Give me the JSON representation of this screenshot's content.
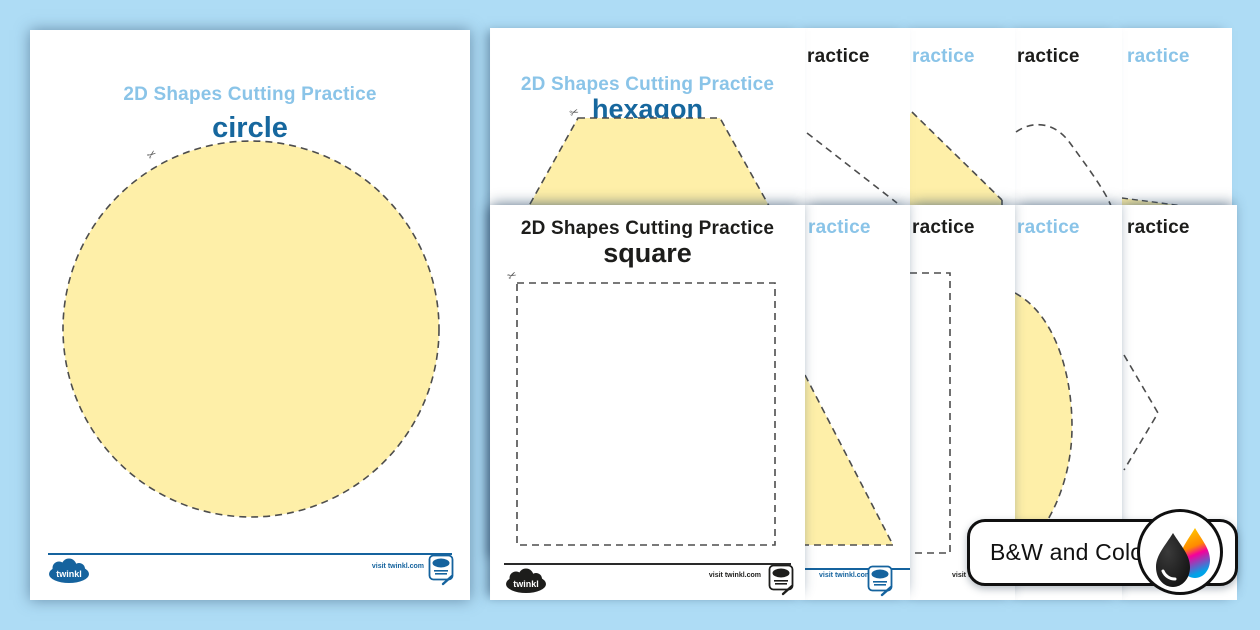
{
  "title": "2D Shapes Cutting Practice",
  "worksheets": {
    "circle": {
      "header": "2D Shapes Cutting Practice",
      "label": "circle",
      "variant": "color"
    },
    "hexagon": {
      "header": "2D Shapes Cutting Practice",
      "label": "hexagon",
      "variant": "color"
    },
    "square": {
      "header": "2D Shapes Cutting Practice",
      "label": "square",
      "variant": "black-and-white"
    },
    "partials": [
      {
        "header_fragment": "ractice",
        "variant": "black-and-white"
      },
      {
        "header_fragment": "ractice",
        "variant": "color"
      },
      {
        "header_fragment": "ractice",
        "variant": "black-and-white"
      },
      {
        "header_fragment": "ractice",
        "variant": "color"
      },
      {
        "header_fragment": "ractice",
        "variant": "color"
      },
      {
        "header_fragment": "ractice",
        "variant": "black-and-white"
      },
      {
        "header_fragment": "ractice",
        "variant": "color"
      },
      {
        "header_fragment": "ractice",
        "variant": "black-and-white"
      }
    ]
  },
  "footer": {
    "brand": "twinkl",
    "visit_text": "visit twinkl.com"
  },
  "badge": {
    "label": "B&W and Color",
    "icon": "ink-drops-icon"
  },
  "colors": {
    "background": "#aedcf5",
    "header_blue": "#8ac4e8",
    "shape_name_blue": "#16679e",
    "footer_blue": "#15639e",
    "shape_fill_yellow": "#feefa8",
    "dash_gray": "#4d4d4d",
    "bw_text": "#1d1d1b"
  }
}
